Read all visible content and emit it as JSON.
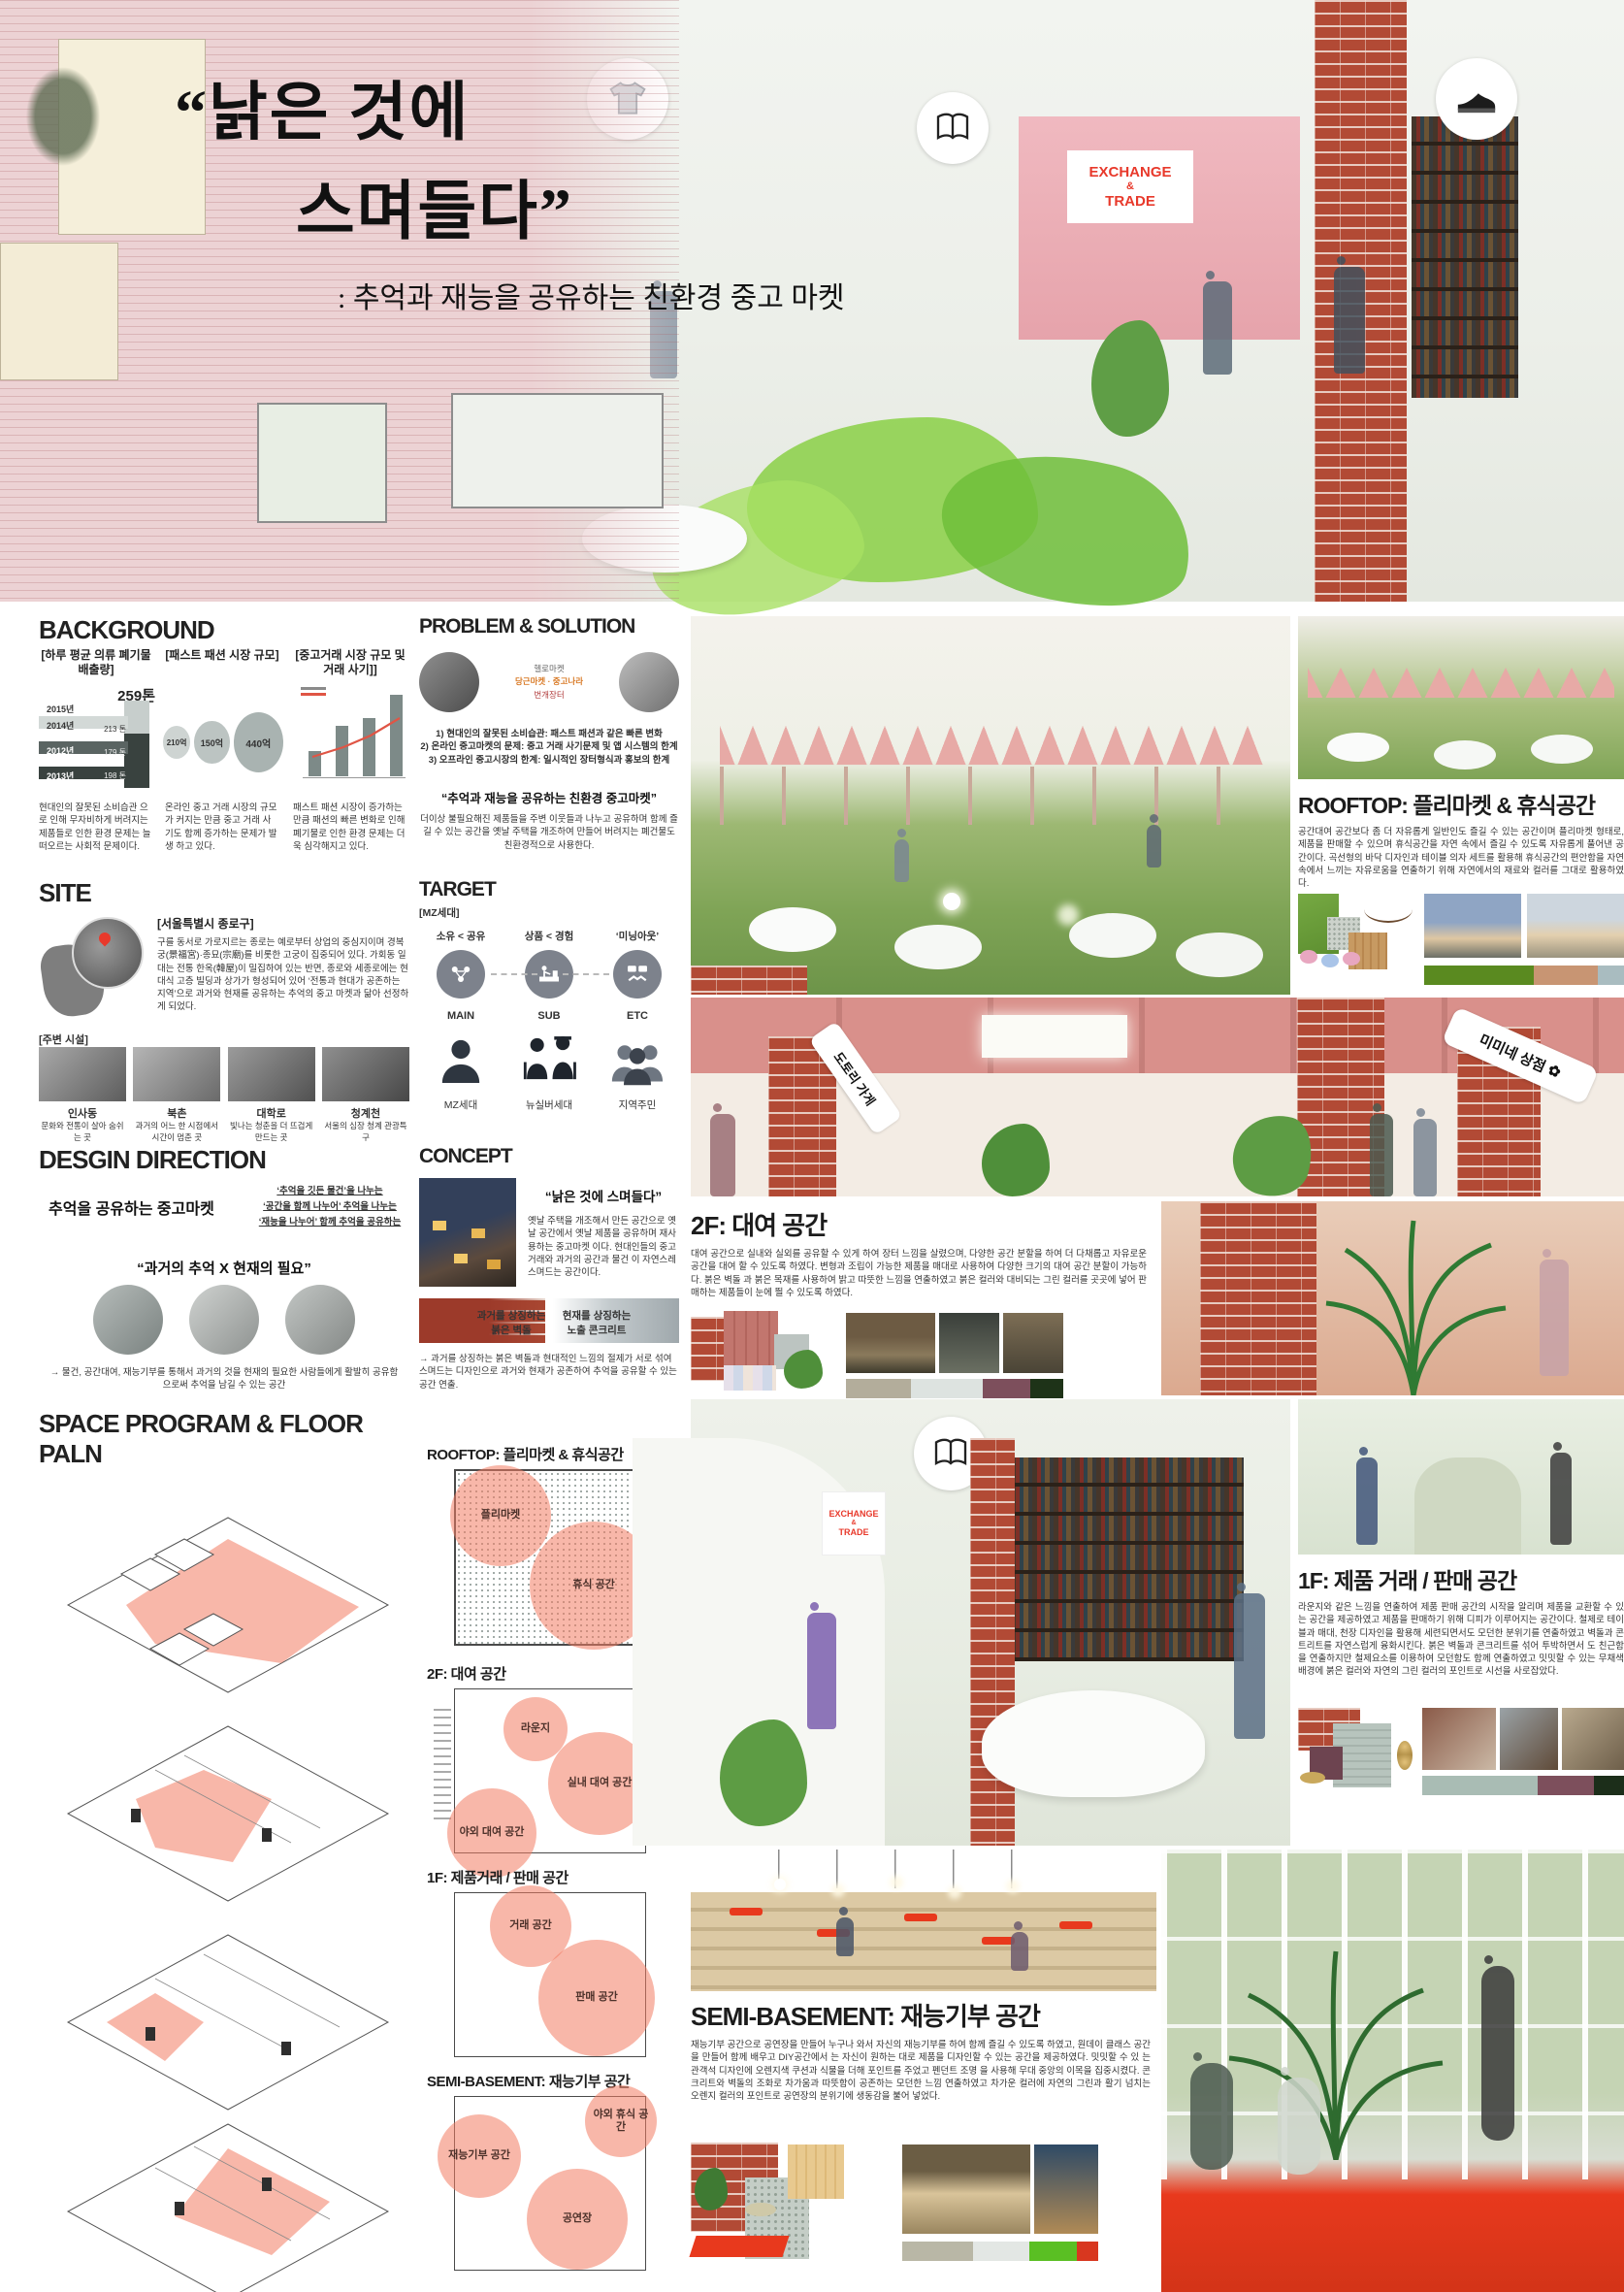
{
  "colors": {
    "accent_salmon": "#F37C62",
    "sign_red": "#E8392B",
    "brick_red": "#B24A35",
    "grass_green": "#7FA456",
    "foliage_green": "#8FD14F",
    "ceiling_pink": "#D9908B"
  },
  "hero": {
    "title_line1": "“낡은 것에",
    "title_line2": "스며들다”",
    "subtitle": ": 추억과 재능을 공유하는 친환경 중고 마켓"
  },
  "signage": {
    "line1": "EXCHANGE",
    "line2": "&",
    "line3": "TRADE"
  },
  "background": {
    "heading": "BACKGROUND",
    "cols": [
      {
        "label": "[하루 평균 의류 폐기물 배출량]",
        "caption": "현대인의 잘못된 소비습관 으로 인해 무자비하게 버려지는 제품들로 인한 환경 문제는 늘 떠오르는 사회적 문제이다."
      },
      {
        "label": "[패스트 패션 시장 규모]",
        "caption": "온라인 중고 거래 시장의 규모가 커지는 만큼 중고 거래 사기도 함께 증가하는 문제가 발생 하고 있다."
      },
      {
        "label": "[중고거래 시장 규모 및 거래 사기]]",
        "caption": "패스트 패션 시장이 증가하는 만큼 패션의 빠른 변화로 인해 폐기물로 인한 환경 문제는 더욱 심각해지고 있다."
      }
    ]
  },
  "chart_data": [
    {
      "type": "bar",
      "title": "[하루 평균 의류 폐기물 배출량]",
      "orientation": "horizontal-3d",
      "categories": [
        "2015년",
        "2014년",
        "2012년",
        "2013년"
      ],
      "values": [
        259,
        213,
        179,
        198
      ],
      "unit": "톤",
      "value_labels": [
        "259톤",
        "213 톤",
        "179 톤",
        "198 톤"
      ]
    },
    {
      "type": "bubble",
      "title": "[패스트 패션 시장 규모]",
      "labels": [
        "210억",
        "150억",
        "440억"
      ],
      "values": [
        210,
        150,
        440
      ]
    },
    {
      "type": "bar+line",
      "title": "[중고거래 시장 규모 및 거래 사기]]",
      "bars_relative": [
        30,
        62,
        72,
        100
      ],
      "trend_line": true,
      "labels_illegible": true
    }
  ],
  "problem_solution": {
    "heading": "PROBLEM & SOLUTION",
    "apps": [
      "당근마켓",
      "중고나라",
      "번개장터",
      "헬로마켓"
    ],
    "items": [
      "1) 현대인의 잘못된 소비습관: 패스트 패션과 같은 빠른 변화",
      "2) 온라인 중고마켓의 문제: 중고 거래 사기문제 및 앱 시스템의 한계",
      "3) 오프라인 중고시장의 한계: 일시적인 장터형식과 홍보의 한계"
    ],
    "slogan": "“추억과 재능을 공유하는 친환경 중고마켓”",
    "description": "더이상 불필요해진 제품들을 주변 이웃들과 나누고 공유하며 함께 즐길 수 있는 공간을 옛날 주택을 개조하여 만들어 버려지는 폐건물도 친환경적으로 사용한다."
  },
  "site": {
    "heading": "SITE",
    "location_label": "[서울특별시 종로구]",
    "description": "구를 동서로 가로지르는 종로는 예로부터 상업의 중심지이며 경복궁(景福宮)·종묘(宗廟)를 비롯한 고궁이 집중되어 있다. 가회동 일대는 전통 한옥(韓屋)이 밀집하여 있는 반면, 종로와 세종로에는 현대식 고층 빌딩과 상가가 형성되어 있어 ‘전통과 현대가 공존하는 지역’으로 과거와 현재를 공유하는 추억의 중고 마켓과 닮아 선정하게 되었다.",
    "nearby_label": "[주변 시설]",
    "nearby": [
      {
        "name": "인사동",
        "desc": "문화와 전통이 살아 숨쉬는 곳"
      },
      {
        "name": "북촌",
        "desc": "과거의 어느 한 시점에서 시간이 멈춘 곳"
      },
      {
        "name": "대학로",
        "desc": "빛나는 청춘을 더 뜨겁게 만드는 곳"
      },
      {
        "name": "청계천",
        "desc": "서울의 심장 청계 관광특구"
      }
    ]
  },
  "target": {
    "heading": "TARGET",
    "segment_label": "[MZ세대]",
    "traits": [
      "소유 < 공유",
      "상품 < 경험",
      "‘미닝아웃’"
    ],
    "tiers": [
      "MAIN",
      "SUB",
      "ETC"
    ],
    "groups": [
      "MZ세대",
      "뉴실버세대",
      "지역주민"
    ]
  },
  "design_direction": {
    "heading": "DESGIN DIRECTION",
    "statement": "추억을 공유하는 중고마켓",
    "notes": [
      "‘추억을 깃든 물건’을 나누는",
      "‘공간을 함께 나누어’ 추억을 나누는",
      "‘재능을 나누어’ 함께 추억을 공유하는"
    ],
    "formula": "“과거의 추억 X 현재의 필요”",
    "conclusion": "→ 물건, 공간대여, 재능기부를 통해서 과거의 것을 현재의 필요한 사람들에게 활발히 공유함으로써 추억을 남길 수 있는 공간"
  },
  "concept": {
    "heading": "CONCEPT",
    "quote": "“낡은 것에 스며들다”",
    "description": "옛날 주택을 개조해서 만든 공간으로 옛날 공간에서 옛날 제품을 공유하며 재사용하는 중고마켓 이다. 현대인들의 중고거래와 과거의 공간과 물건 이 자연스레 스며드는 공간이다.",
    "materials": [
      {
        "line1": "과거를 상징하는",
        "line2": "붉은 벽돌"
      },
      {
        "line1": "현재를 상징하는",
        "line2": "노출 콘크리트"
      }
    ],
    "conclusion": "→ 과거를 상징하는 붉은 벽돌과 현대적인 느낌의 절제가 서로 섞여 스며드는 디자인으로 과거와 현재가 공존하여 추억을 공유할 수 있는 공간 연출."
  },
  "space_program": {
    "heading": "SPACE PROGRAM & FLOOR PALN",
    "plans": [
      {
        "title": "ROOFTOP: 플리마켓 & 휴식공간",
        "zones": [
          "플리마켓",
          "휴식 공간"
        ]
      },
      {
        "title": "2F: 대여 공간",
        "zones": [
          "라운지",
          "실내 대여 공간",
          "야외 대여 공간"
        ]
      },
      {
        "title": "1F: 제품거래 / 판매 공간",
        "zones": [
          "거래 공간",
          "판매 공간"
        ]
      },
      {
        "title": "SEMI-BASEMENT: 재능기부 공간",
        "zones": [
          "재능기부 공간",
          "야외 휴식 공간",
          "공연장"
        ]
      }
    ]
  },
  "renders": {
    "rooftop": {
      "title": "ROOFTOP: 플리마켓 & 휴식공간",
      "description": "공간대여 공간보다 좀 더 자유롭게 일반인도 즐길 수 있는 공간이며 플리마켓 형태로, 제품을 판매할 수 있으며 휴식공간을 자연 속에서 즐길 수 있도록 자유롭게 풀어낸 공간이다. 곡선형의 바닥 디자인과 테이블 의자 세트를 활용해 휴식공간의 편안함을 자연 속에서 느끼는 자유로움을 연출하기 위해 자연에서의 재료와 컬러를 그대로 활용하였다.",
      "palette": [
        "#5A8A20",
        "#C89573",
        "#A9BCC0"
      ]
    },
    "f2": {
      "title": "2F: 대여 공간",
      "banners": [
        "도토리 가게",
        "미미네 상점"
      ],
      "description": "대여 공간으로 실내와 실외를 공유할 수 있게 하여 장터 느낌을 살렸으며, 다양한 공간 분할을 하여 더 다채롭고 자유로운 공간을 대여 할 수 있도록 하였다. 변형과 조립이 가능한 제품을 매대로 사용하여 다양한 크기의 대여 공간 분할이 가능하다. 붉은 벽돌 과 붉은 목재를 사용하여 밝고 따뜻한 느낌을 연출하였고 붉은 컬러와 대비되는 그린 컬러를 곳곳에 넣어 판매하는 제품들이 눈에 띌 수 있도록 하였다.",
      "palette": [
        "#B3AD9B",
        "#DDE3E0",
        "#7D4F5C",
        "#1E3318"
      ]
    },
    "f1": {
      "title": "1F: 제품 거래 / 판매 공간",
      "description": "라운지와 같은 느낌을 연출하여 제품 판매 공간의 시작을 알리며 제품을 교환할 수 있는 공간을 제공하였고 제품을 판매하기 위해 디피가 이루어지는 공간이다. 철제로 테이블과 매대, 천장 디자인을 활용해 세련되면서도 모던한 분위기를 연출하였고 벽돌과 콘트리트를 자연스럽게 융화시킨다. 붉은 벽돌과 콘크리트를 섞어 투박하면서 도 친근함을 연출하지만 철제요소를 이용하여 모던함도 함께 연출하였고 밋밋할 수 있는 무채색 배경에 붉은 컬러와 자연의 그린 컬러의 포인트로 시선을 사로잡았다.",
      "palette": [
        "#A9BCB4",
        "#7D4F5C",
        "#1C2E1A"
      ]
    },
    "sb": {
      "title": "SEMI-BASEMENT: 재능기부 공간",
      "description": "재능기부 공간으로 공연장을 만들어 누구나 와서 자신의 재능기부를 하여 함께 즐길 수 있도록 하였고, 원데이 클래스 공간을 만들어 함께 배우고 DIY공간에서 는 자신이 원하는 대로 제품을 디자인할 수 있는 공간을 제공하였다. 밋밋할 수 있 는 관객석 디자인에 오렌지색 쿠션과 식물을 더해 포인트를 주었고 펜던트 조명 을 사용해 무대 중앙의 이목을 집중시켰다. 콘크리트와 벽돌의 조화로 차가움과 따뜻함이 공존하는 모던한 느낌 연출하였고 차가운 컬러에 자연의 그린과 활기 넘치는 오렌지 컬러의 포인트로 공연장의 분위기에 생동감을 불어 넣었다.",
      "palette": [
        "#B9B7A6",
        "#E3E7E4",
        "#5ABF23",
        "#D8371F"
      ]
    }
  }
}
